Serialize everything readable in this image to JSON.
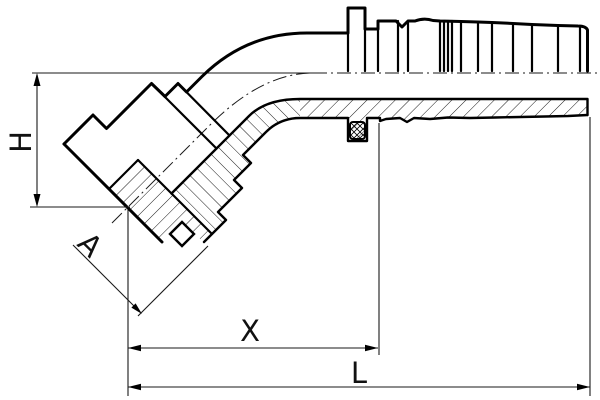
{
  "drawing": {
    "type": "technical-drawing",
    "subject": "45-degree flanged hose fitting, half-section side view",
    "style": "black line art on white, ISO dimensioning"
  },
  "dimensions": {
    "H": {
      "label": "H",
      "orientation": "vertical",
      "measures": "centerline to flange face center"
    },
    "A": {
      "label": "A",
      "orientation": "diagonal-45",
      "measures": "flange head offset"
    },
    "X": {
      "label": "X",
      "orientation": "horizontal",
      "measures": "flange face to hose insertion step"
    },
    "L": {
      "label": "L",
      "orientation": "horizontal",
      "measures": "flange face to nipple end (overall length)"
    }
  },
  "features": {
    "o_ring": "cross-hatched seal ring in groove",
    "barbs": "serrated hose nipple shank",
    "flange": "45-degree flange head with collar",
    "centerlines": "dash-dot horizontal and 45-degree axes"
  },
  "colors": {
    "line": "#000000",
    "background": "#ffffff"
  }
}
